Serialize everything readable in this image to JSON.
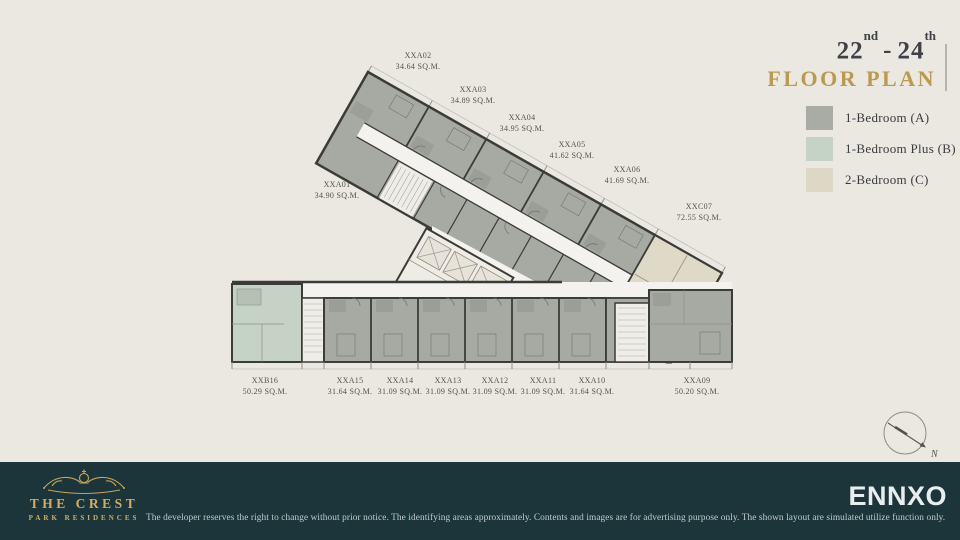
{
  "header": {
    "floor_from": "22",
    "floor_from_suffix": "nd",
    "separator": "-",
    "floor_to": "24",
    "floor_to_suffix": "th",
    "title": "FLOOR PLAN"
  },
  "legend": {
    "items": [
      {
        "label": "1-Bedroom (A)",
        "color": "#A9ACA4"
      },
      {
        "label": "1-Bedroom Plus (B)",
        "color": "#C5D2C6"
      },
      {
        "label": "2-Bedroom (C)",
        "color": "#DDD8C5"
      }
    ]
  },
  "floor_plan": {
    "compass_label": "N",
    "units": [
      {
        "name": "XXA02",
        "area": "34.64 SQ.M.",
        "type": "A",
        "label_x": 418,
        "label_y": 50
      },
      {
        "name": "XXA03",
        "area": "34.89 SQ.M.",
        "type": "A",
        "label_x": 473,
        "label_y": 84
      },
      {
        "name": "XXA04",
        "area": "34.95 SQ.M.",
        "type": "A",
        "label_x": 522,
        "label_y": 112
      },
      {
        "name": "XXA05",
        "area": "41.62 SQ.M.",
        "type": "A",
        "label_x": 572,
        "label_y": 139
      },
      {
        "name": "XXA06",
        "area": "41.69 SQ.M.",
        "type": "A",
        "label_x": 627,
        "label_y": 164
      },
      {
        "name": "XXC07",
        "area": "72.55 SQ.M.",
        "type": "C",
        "label_x": 699,
        "label_y": 201
      },
      {
        "name": "XXA01",
        "area": "34.90 SQ.M.",
        "type": "A",
        "label_x": 337,
        "label_y": 179
      },
      {
        "name": "XXB16",
        "area": "50.29 SQ.M.",
        "type": "B",
        "label_x": 265,
        "label_y": 375
      },
      {
        "name": "XXA15",
        "area": "31.64 SQ.M.",
        "type": "A",
        "label_x": 350,
        "label_y": 375
      },
      {
        "name": "XXA14",
        "area": "31.09 SQ.M.",
        "type": "A",
        "label_x": 400,
        "label_y": 375
      },
      {
        "name": "XXA13",
        "area": "31.09 SQ.M.",
        "type": "A",
        "label_x": 448,
        "label_y": 375
      },
      {
        "name": "XXA12",
        "area": "31.09 SQ.M.",
        "type": "A",
        "label_x": 495,
        "label_y": 375
      },
      {
        "name": "XXA11",
        "area": "31.09 SQ.M.",
        "type": "A",
        "label_x": 543,
        "label_y": 375
      },
      {
        "name": "XXA10",
        "area": "31.64 SQ.M.",
        "type": "A",
        "label_x": 592,
        "label_y": 375
      },
      {
        "name": "XXA09",
        "area": "50.20 SQ.M.",
        "type": "A",
        "label_x": 697,
        "label_y": 375
      }
    ]
  },
  "footer": {
    "brand_line1": "THE CREST",
    "brand_line2": "PARK RESIDENCES",
    "disclaimer": "The developer reserves the right to change without prior notice. The identifying areas approximately. Contents and images are for advertising purpose only. The shown layout are simulated utilize function only.",
    "publisher": "ENNXO"
  },
  "colors": {
    "background": "#EBE8E2",
    "footer_background": "#1B353B",
    "gold": "#BA9A4E",
    "title_dark": "#3F4147",
    "wall": "#3B3B38",
    "corridor": "#F4F2EE",
    "unit_a_gray": "#A7AAA2",
    "unit_b_green": "#C6D2C5",
    "unit_c_beige": "#DFD9C7",
    "publisher_white": "#E9EDED",
    "brand_gold": "#D3AD62"
  }
}
